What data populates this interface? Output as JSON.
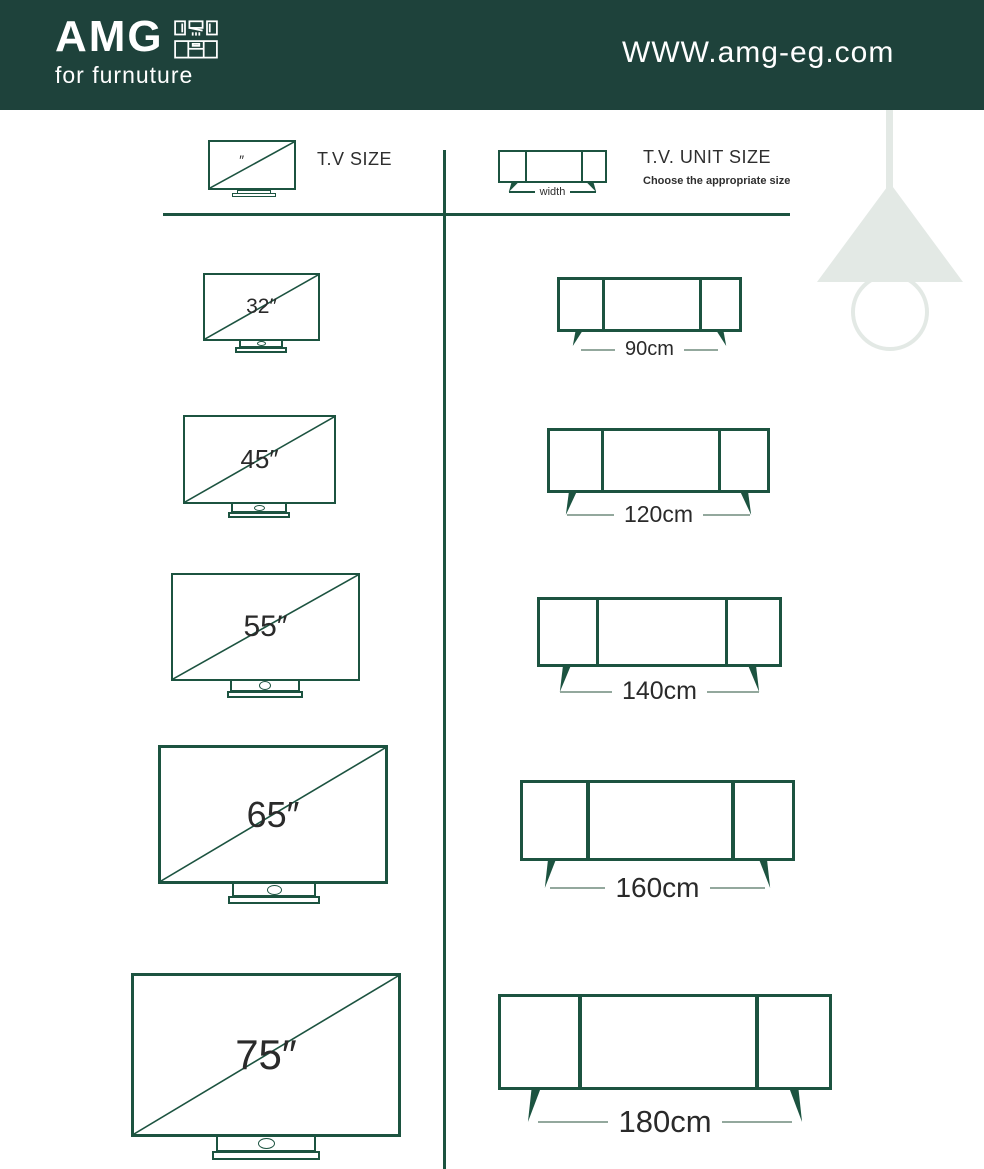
{
  "header": {
    "logo": "AMG",
    "tagline": "for furnuture",
    "website": "WWW.amg-eg.com"
  },
  "left_column": {
    "title": "T.V SIZE",
    "tv_icon_mark": "″"
  },
  "right_column": {
    "title": "T.V. UNIT SIZE",
    "subtitle": "Choose the appropriate size",
    "width_label": "width"
  },
  "rows": [
    {
      "tv": "32″",
      "unit": "90cm"
    },
    {
      "tv": "45″",
      "unit": "120cm"
    },
    {
      "tv": "55″",
      "unit": "140cm"
    },
    {
      "tv": "65″",
      "unit": "160cm"
    },
    {
      "tv": "75″",
      "unit": "180cm"
    }
  ],
  "colors": {
    "header_background": "#1E423B",
    "outline_green": "#1C5340",
    "text_dark": "#2E2E2E",
    "label_line": "#93A89D",
    "lamp": "#E3E9E5"
  }
}
